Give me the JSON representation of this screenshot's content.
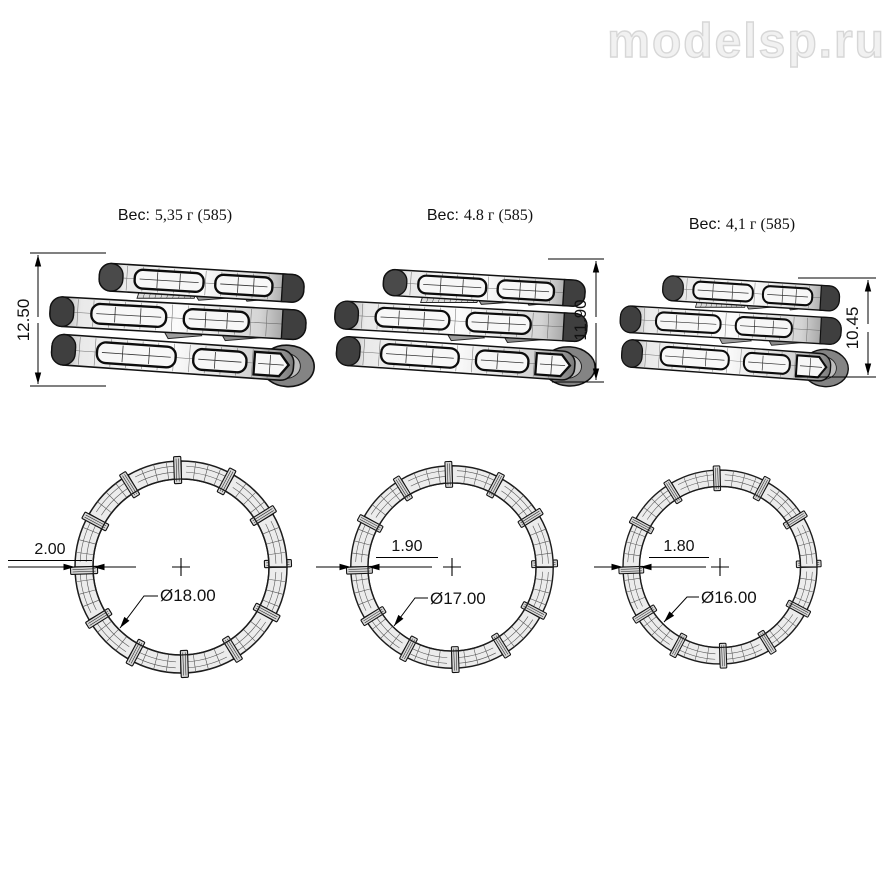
{
  "watermark": "modelsp.ru",
  "drawing": {
    "type": "jewelry-ring-technical-drawing",
    "variants": [
      {
        "weight_prefix": "Вес:",
        "weight_value": "5,35 г (585)",
        "height": "12.50",
        "band_thickness": "2.00",
        "inner_diameter": "Ø18.00"
      },
      {
        "weight_prefix": "Вес:",
        "weight_value": "4.8 г (585)",
        "height": "11.90",
        "band_thickness": "1.90",
        "inner_diameter": "Ø17.00"
      },
      {
        "weight_prefix": "Вес:",
        "weight_value": "4,1 г (585)",
        "height": "10.45",
        "band_thickness": "1.80",
        "inner_diameter": "Ø16.00"
      }
    ]
  }
}
